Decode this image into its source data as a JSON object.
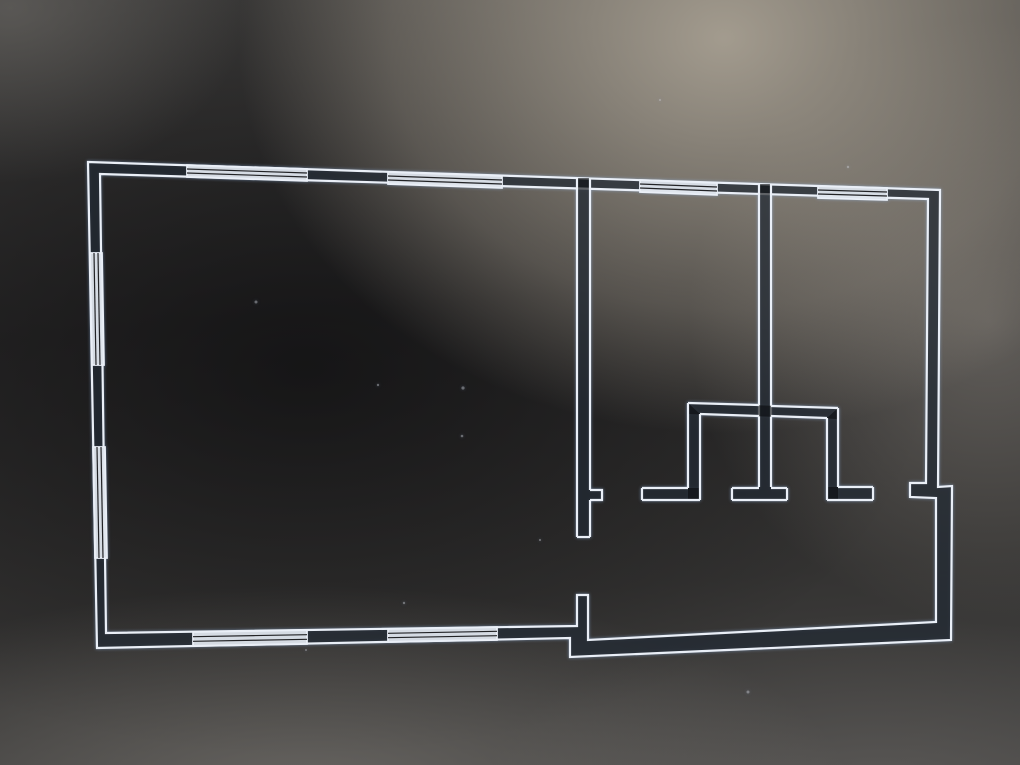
{
  "canvas": {
    "width": 1020,
    "height": 765
  },
  "colors": {
    "line": "#eaeff7",
    "wall_fill": "rgba(10,11,13,0.62)",
    "window_fill": "rgba(223,229,237,0.95)",
    "window_mullion": "#222326",
    "dust": "rgba(212,216,222,0.40)"
  },
  "stroke_widths": {
    "wall_line": 2.2,
    "mullion": 1.2
  },
  "plan": {
    "exterior_ring": {
      "outer": [
        [
          88,
          162
        ],
        [
          940,
          190
        ],
        [
          938,
          487
        ],
        [
          952,
          486
        ],
        [
          951,
          640
        ],
        [
          570,
          657
        ],
        [
          570,
          638
        ],
        [
          97,
          648
        ]
      ],
      "inner": [
        [
          100,
          174
        ],
        [
          928,
          199
        ],
        [
          926,
          483
        ],
        [
          910,
          483
        ],
        [
          910,
          497
        ],
        [
          936,
          498
        ],
        [
          936,
          622
        ],
        [
          588,
          640
        ],
        [
          588,
          595
        ],
        [
          577,
          595
        ],
        [
          577,
          626
        ],
        [
          106,
          633
        ]
      ]
    },
    "interior_walls": [
      {
        "name": "living-room-divider-wall",
        "fills": [
          [
            [
              577,
              178
            ],
            [
              590,
              178
            ],
            [
              590,
              537
            ],
            [
              577,
              537
            ]
          ],
          [
            [
              590,
              490
            ],
            [
              602,
              490
            ],
            [
              602,
              500
            ],
            [
              590,
              500
            ]
          ]
        ],
        "strokes": [
          [
            [
              577,
              178
            ],
            [
              577,
              537
            ]
          ],
          [
            [
              590,
              178
            ],
            [
              590,
              490
            ]
          ],
          [
            [
              590,
              490
            ],
            [
              602,
              490
            ],
            [
              602,
              500
            ],
            [
              590,
              500
            ]
          ],
          [
            [
              590,
              500
            ],
            [
              590,
              537
            ]
          ],
          [
            [
              577,
              537
            ],
            [
              590,
              537
            ]
          ]
        ]
      },
      {
        "name": "bedroom-divider-wall",
        "fills": [
          [
            [
              759,
              184
            ],
            [
              771,
              184
            ],
            [
              771,
              487
            ],
            [
              759,
              487
            ]
          ]
        ],
        "strokes": [
          [
            [
              759,
              184
            ],
            [
              759,
              487
            ]
          ],
          [
            [
              771,
              184
            ],
            [
              771,
              487
            ]
          ]
        ]
      },
      {
        "name": "closet-top-wall",
        "fills": [
          [
            [
              688,
              403
            ],
            [
              838,
              408
            ],
            [
              838,
              419
            ],
            [
              688,
              414
            ]
          ]
        ],
        "strokes": [
          [
            [
              688,
              403
            ],
            [
              759,
              405
            ]
          ],
          [
            [
              771,
              406
            ],
            [
              838,
              408
            ]
          ],
          [
            [
              700,
              414
            ],
            [
              759,
              416
            ]
          ],
          [
            [
              771,
              416
            ],
            [
              827,
              418
            ]
          ]
        ]
      },
      {
        "name": "closet-left-wall-with-jamb",
        "fills": [
          [
            [
              688,
              403
            ],
            [
              700,
              414
            ],
            [
              700,
              500
            ],
            [
              688,
              500
            ]
          ],
          [
            [
              642,
              488
            ],
            [
              700,
              488
            ],
            [
              700,
              500
            ],
            [
              642,
              500
            ]
          ]
        ],
        "strokes": [
          [
            [
              688,
              403
            ],
            [
              688,
              488
            ]
          ],
          [
            [
              688,
              488
            ],
            [
              642,
              488
            ]
          ],
          [
            [
              642,
              488
            ],
            [
              642,
              500
            ]
          ],
          [
            [
              642,
              500
            ],
            [
              700,
              500
            ]
          ],
          [
            [
              700,
              414
            ],
            [
              700,
              500
            ]
          ]
        ]
      },
      {
        "name": "closet-right-wall-with-jamb",
        "fills": [
          [
            [
              827,
              418
            ],
            [
              838,
              408
            ],
            [
              838,
              500
            ],
            [
              827,
              500
            ]
          ],
          [
            [
              827,
              487
            ],
            [
              873,
              487
            ],
            [
              873,
              500
            ],
            [
              827,
              500
            ]
          ]
        ],
        "strokes": [
          [
            [
              838,
              408
            ],
            [
              838,
              487
            ]
          ],
          [
            [
              838,
              487
            ],
            [
              873,
              487
            ]
          ],
          [
            [
              873,
              487
            ],
            [
              873,
              500
            ]
          ],
          [
            [
              827,
              500
            ],
            [
              873,
              500
            ]
          ],
          [
            [
              827,
              418
            ],
            [
              827,
              500
            ]
          ]
        ]
      },
      {
        "name": "divider-door-jamb-foot",
        "fills": [
          [
            [
              732,
              487
            ],
            [
              787,
              487
            ],
            [
              787,
              500
            ],
            [
              732,
              500
            ]
          ]
        ],
        "strokes": [
          [
            [
              732,
              488
            ],
            [
              759,
              488
            ]
          ],
          [
            [
              771,
              488
            ],
            [
              787,
              488
            ]
          ],
          [
            [
              732,
              500
            ],
            [
              787,
              500
            ]
          ],
          [
            [
              732,
              488
            ],
            [
              732,
              500
            ]
          ],
          [
            [
              787,
              488
            ],
            [
              787,
              500
            ]
          ]
        ]
      }
    ],
    "windows": [
      {
        "name": "window-top-1",
        "quad": [
          [
            187,
            165
          ],
          [
            307,
            169
          ],
          [
            307,
            181
          ],
          [
            187,
            177
          ]
        ]
      },
      {
        "name": "window-top-2",
        "quad": [
          [
            388,
            172
          ],
          [
            502,
            176
          ],
          [
            502,
            188
          ],
          [
            388,
            184
          ]
        ]
      },
      {
        "name": "window-top-3",
        "quad": [
          [
            640,
            180
          ],
          [
            717,
            183
          ],
          [
            717,
            195
          ],
          [
            640,
            192
          ]
        ]
      },
      {
        "name": "window-top-4",
        "quad": [
          [
            818,
            186
          ],
          [
            887,
            188
          ],
          [
            887,
            200
          ],
          [
            818,
            198
          ]
        ]
      },
      {
        "name": "window-left-1",
        "quad": [
          [
            90,
            253
          ],
          [
            92,
            365
          ],
          [
            104,
            365
          ],
          [
            102,
            253
          ]
        ]
      },
      {
        "name": "window-left-2",
        "quad": [
          [
            93,
            447
          ],
          [
            95,
            558
          ],
          [
            107,
            558
          ],
          [
            105,
            447
          ]
        ]
      },
      {
        "name": "window-bottom-1",
        "quad": [
          [
            193,
            646
          ],
          [
            307,
            644
          ],
          [
            307,
            630
          ],
          [
            193,
            632
          ]
        ]
      },
      {
        "name": "window-bottom-2",
        "quad": [
          [
            388,
            642
          ],
          [
            497,
            640
          ],
          [
            497,
            627
          ],
          [
            388,
            629
          ]
        ]
      }
    ],
    "dust_specks": [
      [
        256,
        302,
        1.5
      ],
      [
        378,
        385,
        1.2
      ],
      [
        463,
        388,
        1.6
      ],
      [
        462,
        436,
        1.3
      ],
      [
        404,
        603,
        1.2
      ],
      [
        306,
        650,
        1.0
      ],
      [
        748,
        692,
        1.5
      ],
      [
        848,
        167,
        1.2
      ],
      [
        540,
        540,
        1.1
      ],
      [
        660,
        100,
        1.0
      ]
    ]
  }
}
